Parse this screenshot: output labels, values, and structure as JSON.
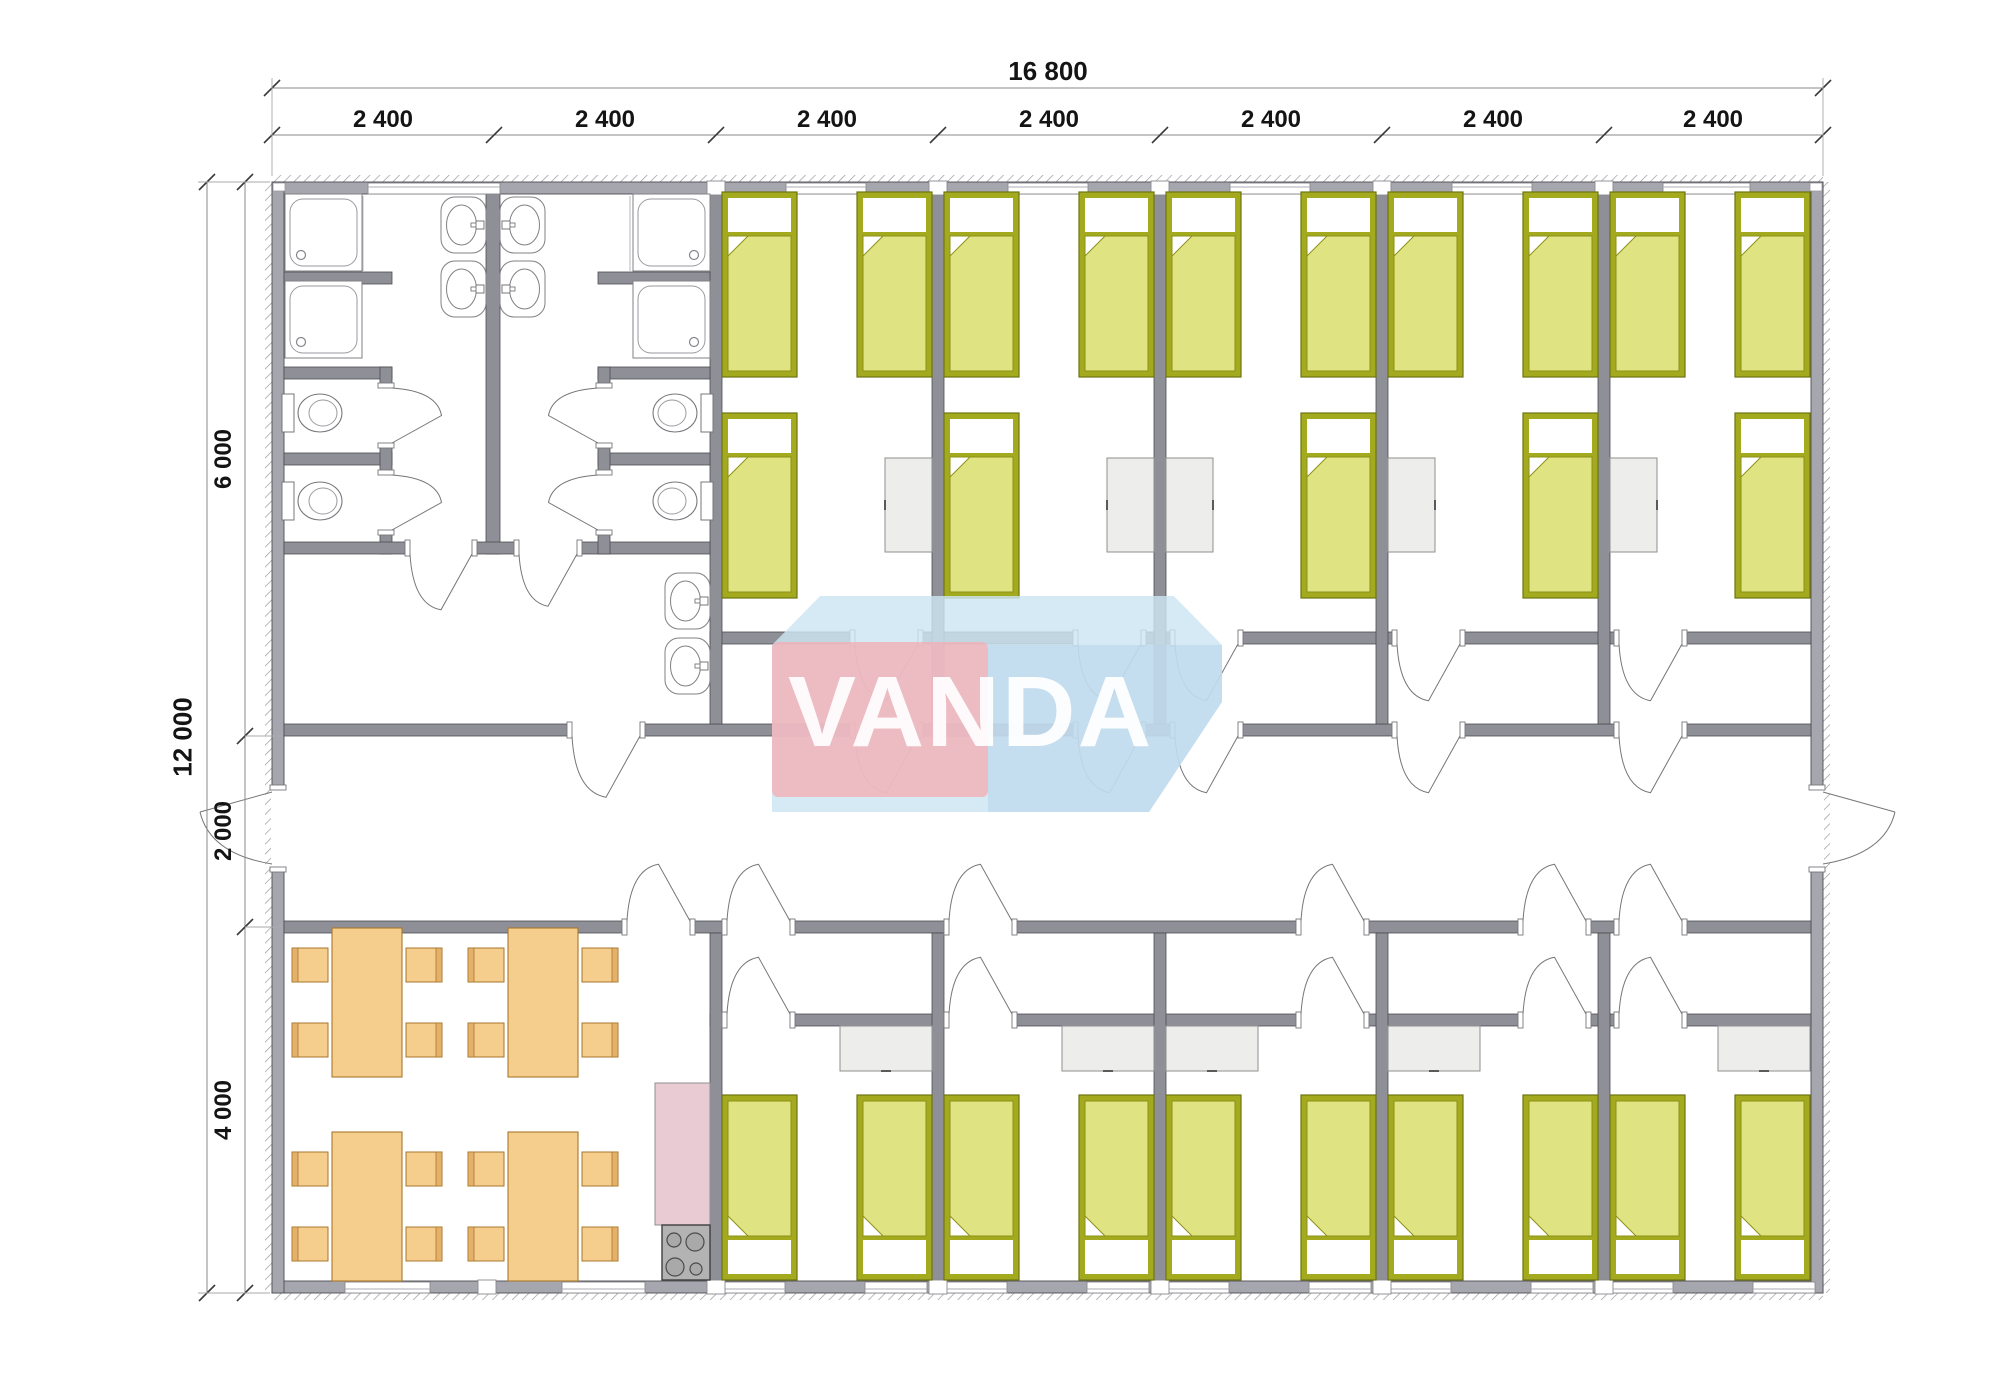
{
  "logo": {
    "text": "VANDA",
    "pink": "#f3aeb5",
    "blue": "#cde5f3"
  },
  "dimensions": {
    "top": {
      "total": "16 800",
      "total_line_y": 88,
      "total_label_cx": 1048,
      "segment_line_y": 135,
      "ticks_x": [
        272,
        494,
        716,
        938,
        1160,
        1382,
        1604,
        1823
      ],
      "segments": [
        {
          "label": "2 400",
          "cx": 383
        },
        {
          "label": "2 400",
          "cx": 605
        },
        {
          "label": "2 400",
          "cx": 827
        },
        {
          "label": "2 400",
          "cx": 1049
        },
        {
          "label": "2 400",
          "cx": 1271
        },
        {
          "label": "2 400",
          "cx": 1493
        },
        {
          "label": "2 400",
          "cx": 1713
        }
      ]
    },
    "left": {
      "total": "12 000",
      "total_line_x": 207,
      "total_label_cy": 737,
      "segment_line_x": 245,
      "ticks_y": [
        182,
        736,
        927,
        1293
      ],
      "segments": [
        {
          "label": "6 000",
          "cy": 459
        },
        {
          "label": "2 000",
          "cy": 831
        },
        {
          "label": "4 000",
          "cy": 1110
        }
      ]
    },
    "extension_lines": [
      [
        272,
        176,
        272,
        78
      ],
      [
        1823,
        176,
        1823,
        78
      ],
      [
        198,
        182,
        270,
        182
      ],
      [
        198,
        1293,
        270,
        1293
      ],
      [
        245,
        736,
        282,
        736
      ],
      [
        245,
        927,
        282,
        927
      ]
    ]
  },
  "colors": {
    "wall_ext": "#a6a7ae",
    "wall_int": "#8f9097",
    "wall_stroke": "#4d4d52",
    "bed_frame": "#a4aa1e",
    "bed_frame_stroke": "#6d7410",
    "mattress": "#e0e382",
    "mattress_stroke": "#8d9216",
    "desk": "#ededeb",
    "desk_stroke": "#8f8f8f",
    "table": "#f5cd8c",
    "table_stroke": "#a8772e",
    "chair_back": "#e3b169",
    "counter": "#e9cbd3",
    "stove": "#b3b3b3",
    "stove_stroke": "#3f3f3f",
    "fixture_stroke": "#808085",
    "door_stroke": "#767676",
    "dim_line": "#8a8a8a",
    "tick": "#3a3a3a"
  },
  "plan": {
    "building": [
      272,
      182,
      1551,
      1111
    ],
    "hatch_strips": [
      [
        272,
        175,
        1551,
        7
      ],
      [
        272,
        1293,
        1551,
        7
      ],
      [
        265,
        182,
        7,
        1111
      ],
      [
        1823,
        182,
        7,
        1111
      ]
    ],
    "walls_ext": [
      [
        272,
        182,
        1551,
        12
      ],
      [
        272,
        1281,
        1551,
        12
      ],
      [
        272,
        182,
        12,
        1111
      ],
      [
        1811,
        182,
        12,
        1111
      ]
    ],
    "walls_int": [
      [
        284,
        724,
        1527,
        12
      ],
      [
        284,
        921,
        1527,
        12
      ],
      [
        710,
        632,
        1101,
        12
      ],
      [
        710,
        1014,
        1101,
        12
      ],
      [
        710,
        194,
        12,
        530
      ],
      [
        932,
        194,
        12,
        530
      ],
      [
        1154,
        194,
        12,
        530
      ],
      [
        1376,
        194,
        12,
        530
      ],
      [
        1598,
        194,
        12,
        530
      ],
      [
        710,
        933,
        12,
        348
      ],
      [
        932,
        933,
        12,
        348
      ],
      [
        1154,
        933,
        12,
        348
      ],
      [
        1376,
        933,
        12,
        348
      ],
      [
        1598,
        933,
        12,
        348
      ],
      [
        486,
        194,
        14,
        360
      ],
      [
        284,
        272,
        108,
        12
      ],
      [
        284,
        367,
        108,
        12
      ],
      [
        284,
        453,
        108,
        12
      ],
      [
        380,
        367,
        12,
        187
      ],
      [
        284,
        542,
        126,
        12
      ],
      [
        472,
        542,
        51,
        12
      ],
      [
        577,
        542,
        133,
        12
      ],
      [
        598,
        272,
        112,
        12
      ],
      [
        598,
        367,
        112,
        12
      ],
      [
        598,
        453,
        112,
        12
      ],
      [
        598,
        367,
        12,
        187
      ]
    ],
    "windows": {
      "top_y": 183,
      "top": [
        [
          368,
          132
        ],
        [
          786,
          80
        ],
        [
          1008,
          80
        ],
        [
          1230,
          80
        ],
        [
          1452,
          80
        ],
        [
          1663,
          87
        ]
      ],
      "bottom_y": 1282,
      "bottom": [
        [
          345,
          85
        ],
        [
          562,
          83
        ],
        [
          723,
          62
        ],
        [
          865,
          62
        ],
        [
          945,
          62
        ],
        [
          1087,
          62
        ],
        [
          1167,
          62
        ],
        [
          1309,
          62
        ],
        [
          1389,
          62
        ],
        [
          1531,
          62
        ],
        [
          1611,
          62
        ],
        [
          1753,
          62
        ]
      ]
    },
    "joints": {
      "top_y": 181,
      "top": [
        707,
        929,
        1151,
        1373,
        1595
      ],
      "bottom_y": 1280,
      "bottom": [
        478,
        707,
        929,
        1151,
        1373,
        1595
      ],
      "w": 18
    },
    "corner_notches": [
      [
        273,
        183,
        12,
        8
      ],
      [
        1810,
        183,
        12,
        8
      ]
    ],
    "doors_h": [
      [
        855,
        632,
        63
      ],
      [
        1078,
        632,
        63
      ],
      [
        1175,
        632,
        63
      ],
      [
        1397,
        632,
        63
      ],
      [
        1619,
        632,
        63
      ],
      [
        572,
        724,
        68
      ],
      [
        855,
        724,
        63
      ],
      [
        1078,
        724,
        63
      ],
      [
        1175,
        724,
        63
      ],
      [
        1397,
        724,
        63
      ],
      [
        1619,
        724,
        63
      ],
      [
        627,
        921,
        63
      ],
      [
        727,
        921,
        63
      ],
      [
        949,
        921,
        63
      ],
      [
        1301,
        921,
        63
      ],
      [
        1523,
        921,
        63
      ],
      [
        1619,
        921,
        63
      ],
      [
        727,
        1014,
        63
      ],
      [
        949,
        1014,
        63
      ],
      [
        1301,
        1014,
        63
      ],
      [
        1523,
        1014,
        63
      ],
      [
        1619,
        1014,
        63
      ],
      [
        410,
        542,
        62
      ],
      [
        519,
        542,
        58
      ]
    ],
    "doors_v": [
      [
        380,
        388,
        55
      ],
      [
        380,
        475,
        55
      ],
      [
        598,
        388,
        55
      ],
      [
        598,
        475,
        55
      ],
      [
        272,
        790,
        77
      ],
      [
        1811,
        790,
        77
      ]
    ],
    "door_arcs_v": [
      [
        855,
        63,
        644,
        "d"
      ],
      [
        1078,
        63,
        644,
        "d"
      ],
      [
        1175,
        63,
        644,
        "d"
      ],
      [
        1397,
        63,
        644,
        "d"
      ],
      [
        1619,
        63,
        644,
        "d"
      ],
      [
        572,
        68,
        736,
        "d"
      ],
      [
        855,
        63,
        736,
        "d"
      ],
      [
        1078,
        63,
        736,
        "d"
      ],
      [
        1175,
        63,
        736,
        "d"
      ],
      [
        1397,
        63,
        736,
        "d"
      ],
      [
        1619,
        63,
        736,
        "d"
      ],
      [
        410,
        62,
        554,
        "d"
      ],
      [
        519,
        58,
        554,
        "d"
      ],
      [
        627,
        63,
        921,
        "u"
      ],
      [
        727,
        63,
        921,
        "u"
      ],
      [
        949,
        63,
        921,
        "u"
      ],
      [
        1301,
        63,
        921,
        "u"
      ],
      [
        1523,
        63,
        921,
        "u"
      ],
      [
        1619,
        63,
        921,
        "u"
      ],
      [
        727,
        63,
        1014,
        "u"
      ],
      [
        949,
        63,
        1014,
        "u"
      ],
      [
        1301,
        63,
        1014,
        "u"
      ],
      [
        1523,
        63,
        1014,
        "u"
      ],
      [
        1619,
        63,
        1014,
        "u"
      ]
    ],
    "door_arcs_side": [
      [
        392,
        388,
        55,
        "r"
      ],
      [
        392,
        475,
        55,
        "r"
      ],
      [
        598,
        388,
        55,
        "l"
      ],
      [
        598,
        475,
        55,
        "l"
      ]
    ],
    "ext_door_arcs": [
      [
        272,
        790,
        77,
        "l"
      ],
      [
        1811,
        790,
        77,
        "r"
      ]
    ],
    "beds_up": [
      [
        722,
        192
      ],
      [
        857,
        192
      ],
      [
        944,
        192
      ],
      [
        1079,
        192
      ],
      [
        1166,
        192
      ],
      [
        1301,
        192
      ],
      [
        1388,
        192
      ],
      [
        1523,
        192
      ],
      [
        1610,
        192
      ],
      [
        1735,
        192
      ],
      [
        722,
        413
      ],
      [
        944,
        413
      ],
      [
        1301,
        413
      ],
      [
        1523,
        413
      ],
      [
        1735,
        413
      ]
    ],
    "beds_down": [
      [
        722,
        1095
      ],
      [
        857,
        1095
      ],
      [
        944,
        1095
      ],
      [
        1079,
        1095
      ],
      [
        1166,
        1095
      ],
      [
        1301,
        1095
      ],
      [
        1388,
        1095
      ],
      [
        1523,
        1095
      ],
      [
        1610,
        1095
      ],
      [
        1735,
        1095
      ]
    ],
    "bed_size": [
      75,
      185
    ],
    "desks": [
      [
        885,
        458,
        47,
        94,
        "l"
      ],
      [
        1107,
        458,
        47,
        94,
        "l"
      ],
      [
        1166,
        458,
        47,
        94,
        "r"
      ],
      [
        1388,
        458,
        47,
        94,
        "r"
      ],
      [
        1610,
        458,
        47,
        94,
        "r"
      ],
      [
        840,
        1026,
        92,
        45,
        "b"
      ],
      [
        1062,
        1026,
        92,
        45,
        "b"
      ],
      [
        1166,
        1026,
        92,
        45,
        "b"
      ],
      [
        1388,
        1026,
        92,
        45,
        "b"
      ],
      [
        1718,
        1026,
        92,
        45,
        "b"
      ]
    ],
    "tables": [
      [
        332,
        928
      ],
      [
        508,
        928
      ],
      [
        332,
        1132
      ],
      [
        508,
        1132
      ]
    ],
    "table_size": [
      70,
      149
    ],
    "chairs": [
      [
        292,
        948,
        "L"
      ],
      [
        292,
        1023,
        "L"
      ],
      [
        406,
        948,
        "R"
      ],
      [
        406,
        1023,
        "R"
      ],
      [
        468,
        948,
        "L"
      ],
      [
        468,
        1023,
        "L"
      ],
      [
        582,
        948,
        "R"
      ],
      [
        582,
        1023,
        "R"
      ],
      [
        292,
        1152,
        "L"
      ],
      [
        292,
        1227,
        "L"
      ],
      [
        406,
        1152,
        "R"
      ],
      [
        406,
        1227,
        "R"
      ],
      [
        468,
        1152,
        "L"
      ],
      [
        468,
        1227,
        "L"
      ],
      [
        582,
        1152,
        "R"
      ],
      [
        582,
        1227,
        "R"
      ]
    ],
    "chair_size": [
      36,
      34
    ],
    "showers": [
      [
        285,
        194,
        "bl"
      ],
      [
        285,
        281,
        "bl"
      ],
      [
        633,
        194,
        "br"
      ],
      [
        633,
        281,
        "br"
      ]
    ],
    "shower_size": 77,
    "shower_lines": [
      [
        363,
        196,
        363,
        272
      ],
      [
        630,
        196,
        630,
        272
      ]
    ],
    "toilets": [
      [
        318,
        413,
        "r"
      ],
      [
        318,
        501,
        "r"
      ],
      [
        677,
        413,
        "l"
      ],
      [
        677,
        501,
        "l"
      ]
    ],
    "sinks": [
      [
        441,
        197,
        "r"
      ],
      [
        441,
        261,
        "r"
      ],
      [
        500,
        197,
        "l"
      ],
      [
        500,
        261,
        "l"
      ],
      [
        665,
        573,
        "r"
      ],
      [
        665,
        638,
        "r"
      ]
    ],
    "sink_size": [
      45,
      56
    ],
    "kitchen": {
      "counter": [
        655,
        1083,
        55,
        142
      ],
      "stove": [
        662,
        1225,
        48,
        55
      ],
      "burners": [
        [
          674,
          1240,
          7
        ],
        [
          695,
          1242,
          9
        ],
        [
          675,
          1267,
          9
        ],
        [
          696,
          1269,
          6
        ]
      ]
    }
  }
}
